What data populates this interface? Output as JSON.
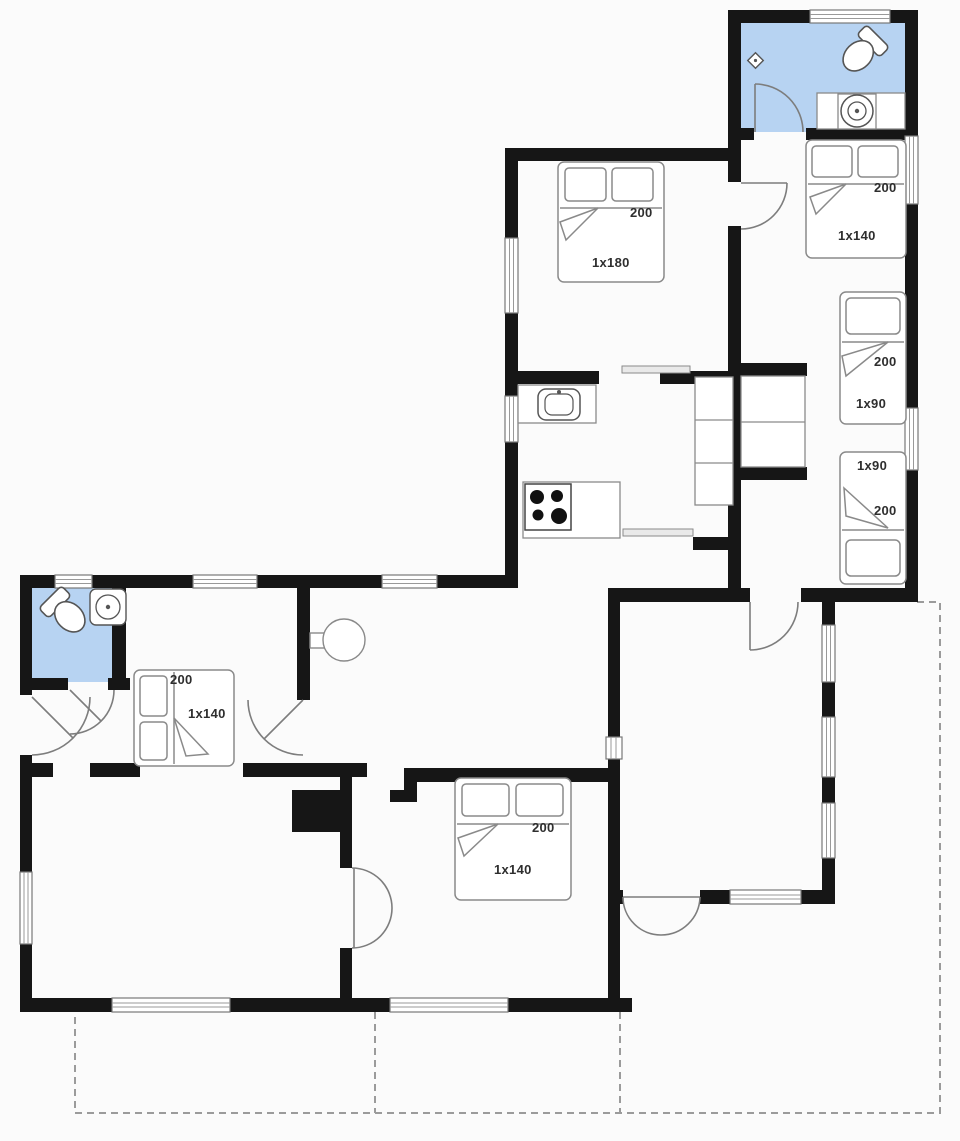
{
  "page": {
    "background": "#fbfbfb"
  },
  "plan": {
    "kind": "holiday-house-floor-plan",
    "colors": {
      "wall": "#161616",
      "bathroom_floor": "#b7d3f2",
      "furniture_line": "#8a8a8a",
      "terrace_dash": "#9b9b9b",
      "background": "#fbfbfb"
    },
    "beds": [
      {
        "id": "bed-northwest",
        "length": "200",
        "size": "1x180"
      },
      {
        "id": "bed-northeast",
        "length": "200",
        "size": "1x140"
      },
      {
        "id": "bed-east-upper",
        "length": "200",
        "size": "1x90"
      },
      {
        "id": "bed-east-lower",
        "length": "200",
        "size": "1x90"
      },
      {
        "id": "bed-west",
        "length": "200",
        "size": "1x140"
      },
      {
        "id": "bed-south",
        "length": "200",
        "size": "1x140"
      }
    ],
    "fixtures": [
      "toilet-icon",
      "round-basin-icon",
      "floor-drain-icon",
      "kitchen-sink-icon",
      "stove-icon",
      "wardrobe-icon",
      "round-table-icon"
    ]
  }
}
